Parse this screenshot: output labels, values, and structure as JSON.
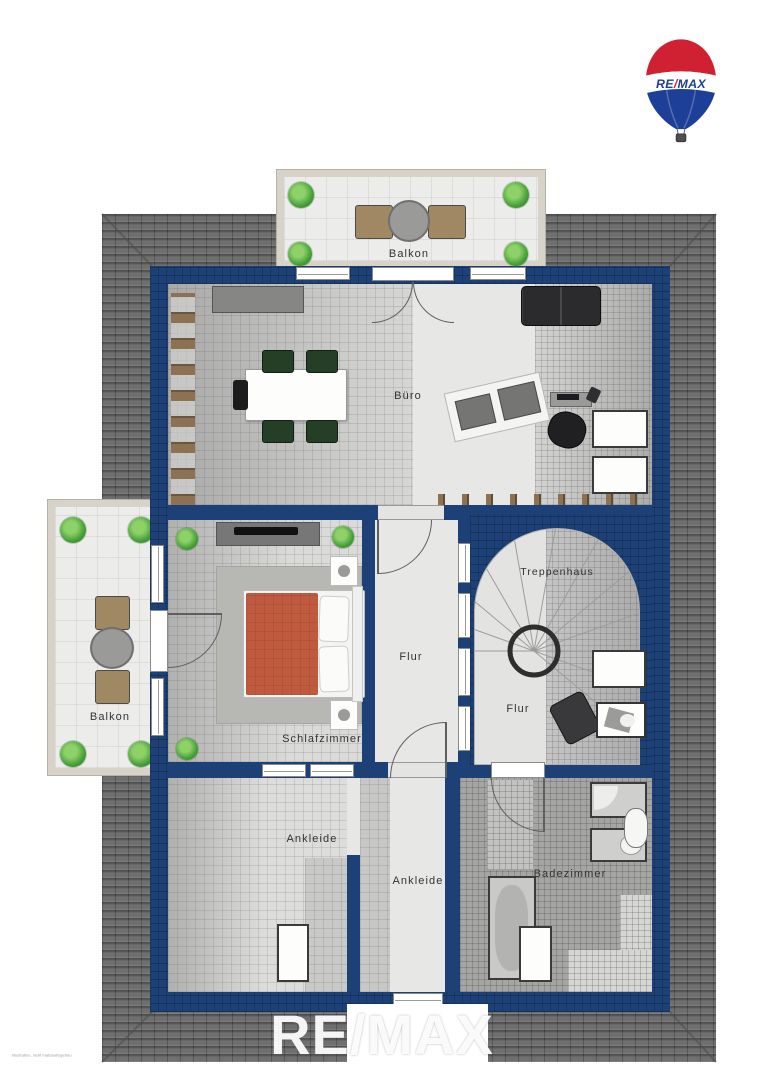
{
  "brand": {
    "balloon": {
      "re": "RE",
      "slash": "/",
      "max": "MAX"
    },
    "watermark": "RE/MAX",
    "colors": {
      "red": "#cf2131",
      "blue": "#1d3f97",
      "wall_navy": "#1d4176",
      "roof_gray": "#6f6f6f",
      "duvet_orange": "#c05a3e"
    }
  },
  "fine_print": "Illustration, nicht maßstabsgetreu",
  "plan": {
    "rooms": [
      {
        "id": "balkon-oben",
        "label": "Balkon"
      },
      {
        "id": "buero",
        "label": "Büro"
      },
      {
        "id": "balkon-links",
        "label": "Balkon"
      },
      {
        "id": "schlafzimmer",
        "label": "Schlafzimmer"
      },
      {
        "id": "flur-mitte",
        "label": "Flur"
      },
      {
        "id": "treppenhaus",
        "label": "Treppenhaus"
      },
      {
        "id": "flur-treppenhaus",
        "label": "Flur"
      },
      {
        "id": "ankleide-links",
        "label": "Ankleide"
      },
      {
        "id": "ankleide-rechts",
        "label": "Ankleide"
      },
      {
        "id": "badezimmer",
        "label": "Badezimmer"
      }
    ]
  }
}
